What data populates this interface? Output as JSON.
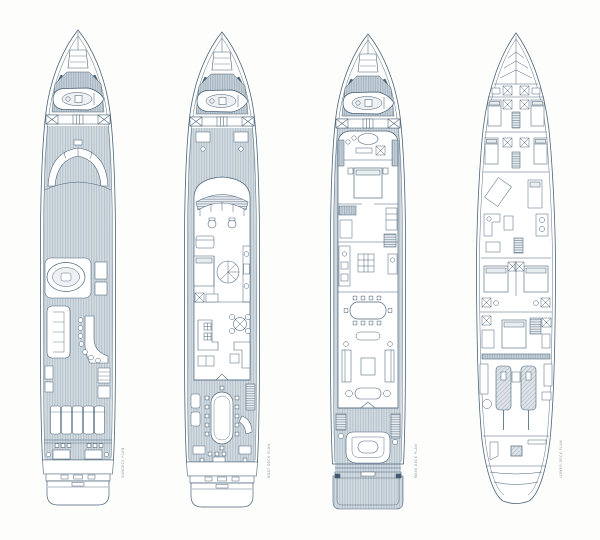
{
  "drawing": {
    "title": "Yacht general arrangement - four deck plans",
    "style": "blueprint line drawing",
    "line_color": "#4a6378",
    "deck_plank_fill": "#d2dae0",
    "deck_plank_line": "#9fb2bf",
    "paper_color": "#fdfdfb"
  },
  "decks": [
    {
      "name": "sun-deck",
      "label": "SUNDECK PLAN",
      "features": [
        "mast arch",
        "jacuzzi",
        "bar with stools",
        "u-sofa",
        "sun pads",
        "aft dining",
        "tender on foredeck"
      ]
    },
    {
      "name": "boat-deck",
      "label": "BOAT DECK PLAN",
      "features": [
        "wheelhouse",
        "pilot chairs",
        "spiral stair",
        "sky lounge bar",
        "game table",
        "aft oval dining table",
        "tender on foredeck"
      ]
    },
    {
      "name": "main-deck",
      "label": "MAIN DECK PLAN",
      "features": [
        "owner stateroom",
        "bath with tub",
        "galley",
        "dining table",
        "salon sofas",
        "aft curved settee",
        "swim platform"
      ]
    },
    {
      "name": "lower-deck",
      "label": "LOWER DECK PLAN",
      "features": [
        "crew cabins",
        "guest cabins",
        "bathrooms",
        "engine room with twin engines",
        "lazarette"
      ]
    }
  ]
}
